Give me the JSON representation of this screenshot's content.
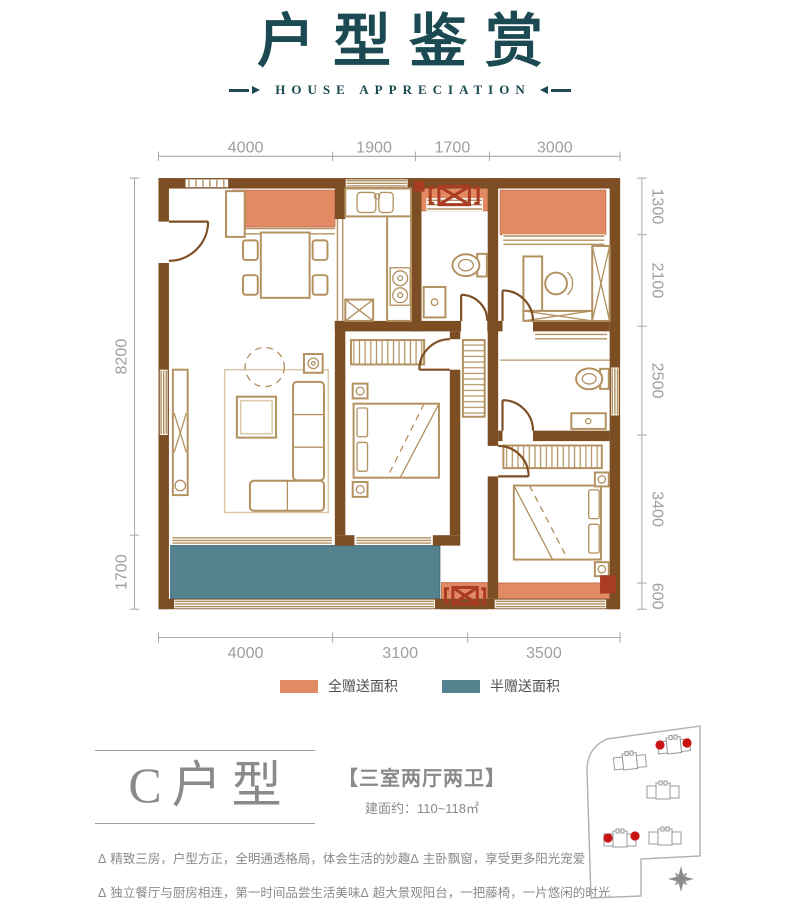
{
  "header": {
    "title": "户型鉴赏",
    "subtitle": "HOUSE APPRECIATION"
  },
  "plan": {
    "dims_top": [
      "4000",
      "1900",
      "1700",
      "3000"
    ],
    "dims_bottom": [
      "4000",
      "3100",
      "3500"
    ],
    "dims_left": [
      "8200",
      "1700"
    ],
    "dims_right": [
      "1300",
      "2100",
      "2500",
      "3400",
      "600"
    ]
  },
  "legend": {
    "full_label": "全赠送面积",
    "half_label": "半赠送面积"
  },
  "unit": {
    "name": "C户型",
    "layout": "【三室两厅两卫】",
    "area": "建面约：110~118㎡"
  },
  "features": {
    "marker": "Δ",
    "items": [
      "精致三房，户型方正，全明通透格局，体会生活的妙趣",
      "主卧飘窗，享受更多阳光宠爱",
      "独立餐厅与厨房相连，第一时间品尝生活美味",
      "超大景观阳台，一把藤椅，一片悠闲的时光"
    ]
  },
  "colors": {
    "ink-teal": "#1c4a52",
    "wall-brown": "#7d4e24",
    "line-tan": "#b2905f",
    "gift-full-orange": "#e18a63",
    "gift-half-teal": "#54828e",
    "accent-dark-red": "#a93c22",
    "dim-gray": "#9f9f9f",
    "text-gray": "#8a8a8a",
    "marker-red": "#c81414"
  }
}
